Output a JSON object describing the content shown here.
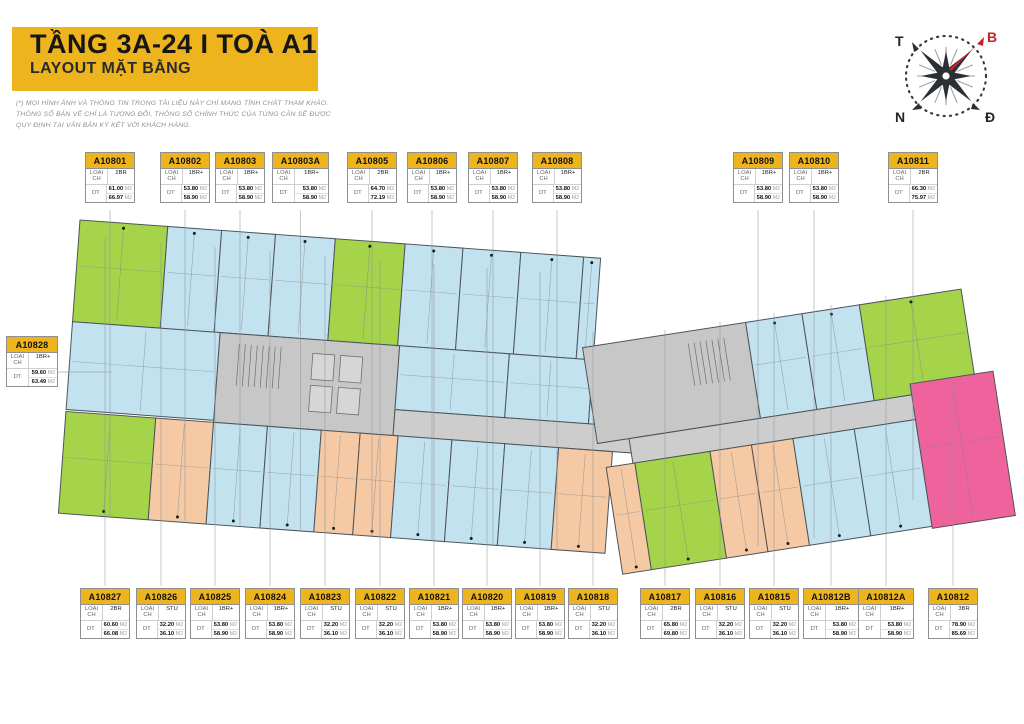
{
  "header": {
    "title": "TẦNG 3A-24  I  TOÀ A1",
    "subtitle": "LAYOUT MẶT BẰNG",
    "disclaimer": [
      "(*) MỌI HÌNH ẢNH VÀ THÔNG TIN TRONG TÀI LIỆU NÀY CHỈ MANG TÍNH CHẤT THAM KHẢO.",
      "THÔNG SỐ BẢN VẼ CHỈ LÀ TƯƠNG ĐỐI, THÔNG SỐ CHÍNH THỨC CỦA TỪNG CĂN SẼ ĐƯỢC",
      "QUY ĐỊNH TẠI VĂN BẢN KÝ KẾT VỚI KHÁCH HÀNG."
    ]
  },
  "compass": {
    "top_left": "T",
    "top_right": "B",
    "bottom_left": "N",
    "bottom_right": "Đ"
  },
  "labels": {
    "type_key": "LOẠI CH",
    "area_key": "DT",
    "area_unit": "M2"
  },
  "palette": {
    "yellow": "#EDB41E",
    "blue": "#C3E2F0",
    "green": "#A5D44B",
    "orange": "#F4C9A3",
    "pink": "#EF639C",
    "core": "#C7C7C7",
    "corridor": "#CDCDCD",
    "wall": "#4D545A",
    "leader": "#8E969B",
    "compass_red": "#CF2027"
  },
  "units": {
    "top": [
      {
        "code": "A10801",
        "type": "2BR",
        "dt": [
          "61.00",
          "66.97"
        ]
      },
      {
        "code": "A10802",
        "type": "1BR+",
        "dt": [
          "53.80",
          "58.90"
        ]
      },
      {
        "code": "A10803",
        "type": "1BR+",
        "dt": [
          "53.80",
          "58.90"
        ]
      },
      {
        "code": "A10803A",
        "type": "1BR+",
        "dt": [
          "53.80",
          "58.90"
        ]
      },
      {
        "code": "A10805",
        "type": "2BR",
        "dt": [
          "64.70",
          "72.19"
        ]
      },
      {
        "code": "A10806",
        "type": "1BR+",
        "dt": [
          "53.80",
          "58.90"
        ]
      },
      {
        "code": "A10807",
        "type": "1BR+",
        "dt": [
          "53.80",
          "58.90"
        ]
      },
      {
        "code": "A10808",
        "type": "1BR+",
        "dt": [
          "53.80",
          "58.90"
        ]
      },
      {
        "code": "A10809",
        "type": "1BR+",
        "dt": [
          "53.80",
          "58.90"
        ]
      },
      {
        "code": "A10810",
        "type": "1BR+",
        "dt": [
          "53.80",
          "58.90"
        ]
      },
      {
        "code": "A10811",
        "type": "2BR",
        "dt": [
          "66.30",
          "75.97"
        ]
      }
    ],
    "left": [
      {
        "code": "A10828",
        "type": "1BR+",
        "dt": [
          "59.60",
          "63.49"
        ]
      }
    ],
    "bottom": [
      {
        "code": "A10827",
        "type": "2BR",
        "dt": [
          "60.60",
          "66.08"
        ]
      },
      {
        "code": "A10826",
        "type": "STU",
        "dt": [
          "32.20",
          "36.10"
        ]
      },
      {
        "code": "A10825",
        "type": "1BR+",
        "dt": [
          "53.80",
          "58.90"
        ]
      },
      {
        "code": "A10824",
        "type": "1BR+",
        "dt": [
          "53.80",
          "58.90"
        ]
      },
      {
        "code": "A10823",
        "type": "STU",
        "dt": [
          "32.20",
          "36.10"
        ]
      },
      {
        "code": "A10822",
        "type": "STU",
        "dt": [
          "32.20",
          "36.10"
        ]
      },
      {
        "code": "A10821",
        "type": "1BR+",
        "dt": [
          "53.80",
          "58.90"
        ]
      },
      {
        "code": "A10820",
        "type": "1BR+",
        "dt": [
          "53.80",
          "58.90"
        ]
      },
      {
        "code": "A10819",
        "type": "1BR+",
        "dt": [
          "53.80",
          "58.90"
        ]
      },
      {
        "code": "A10818",
        "type": "STU",
        "dt": [
          "32.20",
          "36.10"
        ]
      },
      {
        "code": "A10817",
        "type": "2BR",
        "dt": [
          "65.80",
          "69.80"
        ]
      },
      {
        "code": "A10816",
        "type": "STU",
        "dt": [
          "32.20",
          "36.10"
        ]
      },
      {
        "code": "A10815",
        "type": "STU",
        "dt": [
          "32.20",
          "36.10"
        ]
      },
      {
        "code": "A10812B",
        "type": "1BR+",
        "dt": [
          "53.80",
          "58.90"
        ]
      },
      {
        "code": "A10812A",
        "type": "1BR+",
        "dt": [
          "53.80",
          "58.90"
        ]
      },
      {
        "code": "A10812",
        "type": "3BR",
        "dt": [
          "78.90",
          "85.69"
        ]
      }
    ]
  }
}
